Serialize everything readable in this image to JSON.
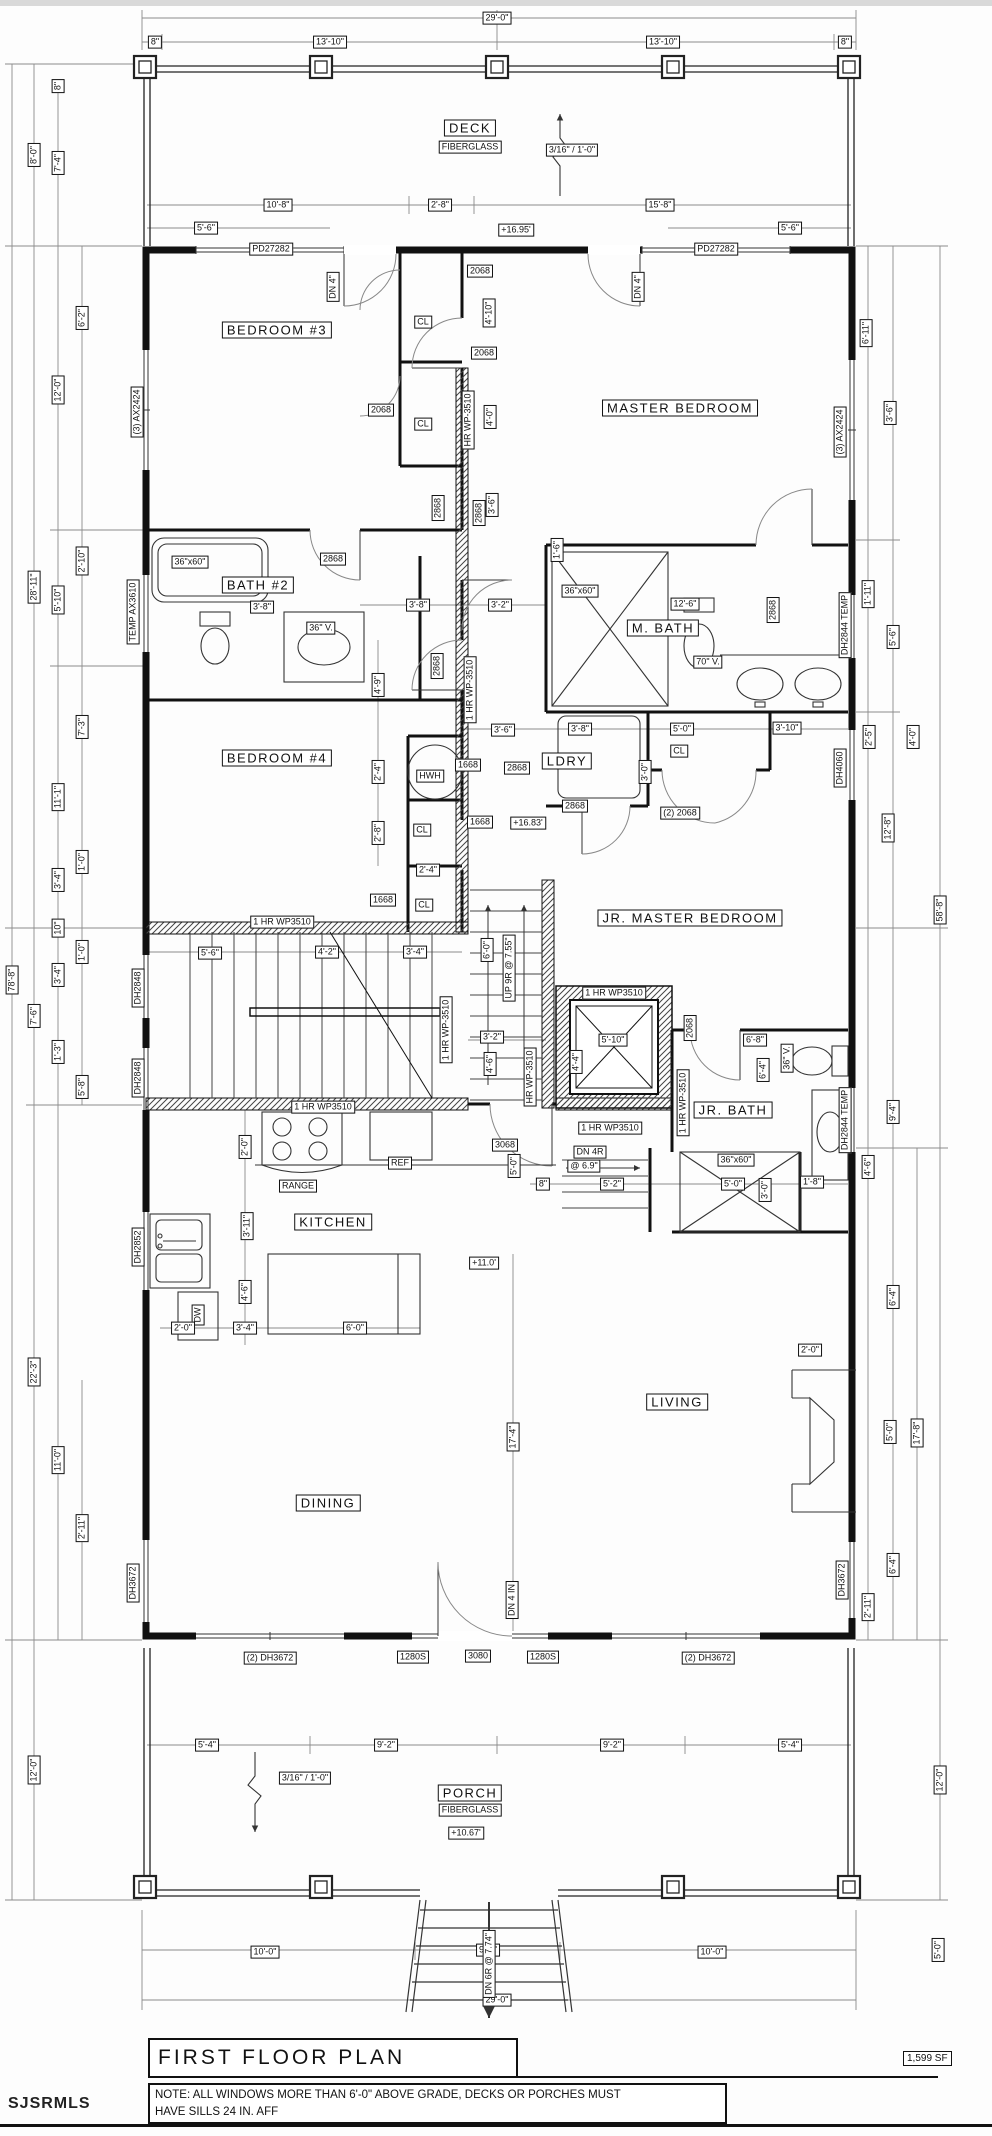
{
  "sheet": {
    "title": "FIRST FLOOR PLAN",
    "area": "1,599 SF",
    "watermark": "SJSRMLS",
    "note": [
      "NOTE:  ALL WINDOWS MORE THAN 6'-0\" ABOVE GRADE, DECKS OR PORCHES MUST",
      "HAVE SILLS 24 IN. AFF"
    ]
  },
  "plan": {
    "rooms": [
      {
        "name": "DECK",
        "x": 470,
        "y": 128
      },
      {
        "name": "BEDROOM #3",
        "x": 277,
        "y": 330
      },
      {
        "name": "MASTER BEDROOM",
        "x": 680,
        "y": 408
      },
      {
        "name": "BATH #2",
        "x": 258,
        "y": 585
      },
      {
        "name": "M. BATH",
        "x": 663,
        "y": 628
      },
      {
        "name": "BEDROOM #4",
        "x": 277,
        "y": 758
      },
      {
        "name": "LDRY",
        "x": 567,
        "y": 761
      },
      {
        "name": "JR. MASTER BEDROOM",
        "x": 690,
        "y": 918
      },
      {
        "name": "JR. BATH",
        "x": 733,
        "y": 1110
      },
      {
        "name": "KITCHEN",
        "x": 333,
        "y": 1222
      },
      {
        "name": "LIVING",
        "x": 677,
        "y": 1402
      },
      {
        "name": "DINING",
        "x": 328,
        "y": 1503
      },
      {
        "name": "PORCH",
        "x": 470,
        "y": 1793
      }
    ],
    "labels": [
      {
        "t": "29'-0\"",
        "x": 497,
        "y": 18
      },
      {
        "t": "8\"",
        "x": 155,
        "y": 42
      },
      {
        "t": "13'-10\"",
        "x": 330,
        "y": 42
      },
      {
        "t": "13'-10\"",
        "x": 663,
        "y": 42
      },
      {
        "t": "8\"",
        "x": 845,
        "y": 42
      },
      {
        "t": "3/16\" / 1'-0\"",
        "x": 572,
        "y": 150
      },
      {
        "t": "FIBERGLASS",
        "x": 470,
        "y": 147
      },
      {
        "t": "10'-8\"",
        "x": 278,
        "y": 205
      },
      {
        "t": "2'-8\"",
        "x": 440,
        "y": 205
      },
      {
        "t": "15'-8\"",
        "x": 660,
        "y": 205
      },
      {
        "t": "5'-6\"",
        "x": 206,
        "y": 228
      },
      {
        "t": "+16.95'",
        "x": 516,
        "y": 230
      },
      {
        "t": "5'-6\"",
        "x": 790,
        "y": 228
      },
      {
        "t": "PD27282",
        "x": 271,
        "y": 249
      },
      {
        "t": "PD27282",
        "x": 716,
        "y": 249
      },
      {
        "t": "DN 4\"",
        "x": 333,
        "y": 287,
        "r": 1
      },
      {
        "t": "DN 4\"",
        "x": 638,
        "y": 287,
        "r": 1
      },
      {
        "t": "2068",
        "x": 480,
        "y": 271
      },
      {
        "t": "4'-10\"",
        "x": 489,
        "y": 313,
        "r": 1
      },
      {
        "t": "2068",
        "x": 484,
        "y": 353
      },
      {
        "t": "CL",
        "x": 423,
        "y": 322
      },
      {
        "t": "CL",
        "x": 423,
        "y": 424
      },
      {
        "t": "2068",
        "x": 381,
        "y": 410
      },
      {
        "t": "HR WP-3510",
        "x": 468,
        "y": 420,
        "r": 1
      },
      {
        "t": "4'-0\"",
        "x": 490,
        "y": 417,
        "r": 1
      },
      {
        "t": "(3) AX2424",
        "x": 137,
        "y": 412,
        "r": 1
      },
      {
        "t": "(3) AX2424",
        "x": 840,
        "y": 432,
        "r": 1
      },
      {
        "t": "6'-11\"",
        "x": 866,
        "y": 333,
        "r": 1
      },
      {
        "t": "3'-6\"",
        "x": 890,
        "y": 413,
        "r": 1
      },
      {
        "t": "2868",
        "x": 438,
        "y": 508,
        "r": 1
      },
      {
        "t": "2868",
        "x": 479,
        "y": 513,
        "r": 1
      },
      {
        "t": "3'-6\"",
        "x": 492,
        "y": 505,
        "r": 1
      },
      {
        "t": "1'-6\"",
        "x": 557,
        "y": 550,
        "r": 1
      },
      {
        "t": "36\"x60\"",
        "x": 190,
        "y": 562
      },
      {
        "t": "3'-8\"",
        "x": 262,
        "y": 607
      },
      {
        "t": "2868",
        "x": 333,
        "y": 559
      },
      {
        "t": "36\" V.",
        "x": 321,
        "y": 628
      },
      {
        "t": "TEMP AX3610",
        "x": 133,
        "y": 612,
        "r": 1
      },
      {
        "t": "3'-8\"",
        "x": 418,
        "y": 605
      },
      {
        "t": "3'-2\"",
        "x": 500,
        "y": 605
      },
      {
        "t": "4'-9\"",
        "x": 378,
        "y": 685,
        "r": 1
      },
      {
        "t": "2868",
        "x": 437,
        "y": 666,
        "r": 1
      },
      {
        "t": "1 HR WP-3510",
        "x": 470,
        "y": 690,
        "r": 1
      },
      {
        "t": "36\"x60\"",
        "x": 580,
        "y": 591
      },
      {
        "t": "12'-6\"",
        "x": 685,
        "y": 604
      },
      {
        "t": "2868",
        "x": 773,
        "y": 610,
        "r": 1
      },
      {
        "t": "70\" V.",
        "x": 708,
        "y": 662
      },
      {
        "t": "DH2844 TEMP",
        "x": 845,
        "y": 625,
        "r": 1
      },
      {
        "t": "1'-11\"",
        "x": 868,
        "y": 594,
        "r": 1
      },
      {
        "t": "5'-6\"",
        "x": 893,
        "y": 637,
        "r": 1
      },
      {
        "t": "2'-4\"",
        "x": 378,
        "y": 772,
        "r": 1
      },
      {
        "t": "HWH",
        "x": 430,
        "y": 776
      },
      {
        "t": "1668",
        "x": 468,
        "y": 765
      },
      {
        "t": "3'-6\"",
        "x": 503,
        "y": 730
      },
      {
        "t": "2868",
        "x": 517,
        "y": 768
      },
      {
        "t": "3'-8\"",
        "x": 580,
        "y": 729
      },
      {
        "t": "5'-0\"",
        "x": 682,
        "y": 729
      },
      {
        "t": "CL",
        "x": 679,
        "y": 751
      },
      {
        "t": "3'-0\"",
        "x": 645,
        "y": 772,
        "r": 1
      },
      {
        "t": "2868",
        "x": 575,
        "y": 806
      },
      {
        "t": "(2) 2068",
        "x": 680,
        "y": 813
      },
      {
        "t": "2'-8\"",
        "x": 378,
        "y": 833,
        "r": 1
      },
      {
        "t": "CL",
        "x": 422,
        "y": 830
      },
      {
        "t": "1668",
        "x": 480,
        "y": 822
      },
      {
        "t": "+16.83'",
        "x": 528,
        "y": 823
      },
      {
        "t": "3'-10\"",
        "x": 787,
        "y": 728
      },
      {
        "t": "DH4060",
        "x": 840,
        "y": 768,
        "r": 1
      },
      {
        "t": "2'-5\"",
        "x": 869,
        "y": 737,
        "r": 1
      },
      {
        "t": "4'-0\"",
        "x": 913,
        "y": 737,
        "r": 1
      },
      {
        "t": "2'-4\"",
        "x": 428,
        "y": 870
      },
      {
        "t": "1668",
        "x": 383,
        "y": 900
      },
      {
        "t": "CL",
        "x": 424,
        "y": 905
      },
      {
        "t": "12'-8\"",
        "x": 888,
        "y": 828,
        "r": 1
      },
      {
        "t": "58'-8\"",
        "x": 940,
        "y": 910,
        "r": 1
      },
      {
        "t": "1 HR WP3510",
        "x": 282,
        "y": 922
      },
      {
        "t": "5'-6\"",
        "x": 210,
        "y": 953
      },
      {
        "t": "4'-2\"",
        "x": 327,
        "y": 952
      },
      {
        "t": "3'-4\"",
        "x": 415,
        "y": 952
      },
      {
        "t": "6'-0\"",
        "x": 487,
        "y": 950,
        "r": 1
      },
      {
        "t": "UP 9R @ 7.55\"",
        "x": 509,
        "y": 968,
        "r": 1
      },
      {
        "t": "DH2848",
        "x": 138,
        "y": 988,
        "r": 1
      },
      {
        "t": "DH2848",
        "x": 138,
        "y": 1078,
        "r": 1
      },
      {
        "t": "1 HR WP-3510",
        "x": 446,
        "y": 1030,
        "r": 1
      },
      {
        "t": "1 HR WP3510",
        "x": 614,
        "y": 993
      },
      {
        "t": "5'-10\"",
        "x": 613,
        "y": 1040
      },
      {
        "t": "4'-4\"",
        "x": 576,
        "y": 1062,
        "r": 1
      },
      {
        "t": "3'-2\"",
        "x": 492,
        "y": 1037
      },
      {
        "t": "4'-6\"",
        "x": 490,
        "y": 1064,
        "r": 1
      },
      {
        "t": "HR WP-3510",
        "x": 530,
        "y": 1077,
        "r": 1
      },
      {
        "t": "2068",
        "x": 690,
        "y": 1028,
        "r": 1
      },
      {
        "t": "1 HR WP-3510",
        "x": 683,
        "y": 1103,
        "r": 1
      },
      {
        "t": "6'-8\"",
        "x": 755,
        "y": 1040
      },
      {
        "t": "6'-4\"",
        "x": 763,
        "y": 1070,
        "r": 1
      },
      {
        "t": "36\" V.",
        "x": 787,
        "y": 1058,
        "r": 1
      },
      {
        "t": "DH2844 TEMP",
        "x": 845,
        "y": 1120,
        "r": 1
      },
      {
        "t": "9'-4\"",
        "x": 893,
        "y": 1112,
        "r": 1
      },
      {
        "t": "4'-6\"",
        "x": 868,
        "y": 1167,
        "r": 1
      },
      {
        "t": "1 HR WP3510",
        "x": 610,
        "y": 1128
      },
      {
        "t": "1 HR WP3510",
        "x": 323,
        "y": 1107
      },
      {
        "t": "DN 4R",
        "x": 590,
        "y": 1152
      },
      {
        "t": "@ 6.9\"",
        "x": 584,
        "y": 1166
      },
      {
        "t": "3068",
        "x": 505,
        "y": 1145
      },
      {
        "t": "5'-0\"",
        "x": 514,
        "y": 1166,
        "r": 1
      },
      {
        "t": "8\"",
        "x": 543,
        "y": 1184
      },
      {
        "t": "5'-2\"",
        "x": 612,
        "y": 1184
      },
      {
        "t": "36\"x60\"",
        "x": 736,
        "y": 1160
      },
      {
        "t": "5'-0\"",
        "x": 733,
        "y": 1184
      },
      {
        "t": "3'-0\"",
        "x": 765,
        "y": 1190,
        "r": 1
      },
      {
        "t": "1'-8\"",
        "x": 812,
        "y": 1182
      },
      {
        "t": "6'-4\"",
        "x": 893,
        "y": 1297,
        "r": 1
      },
      {
        "t": "2'-0\"",
        "x": 245,
        "y": 1147,
        "r": 1
      },
      {
        "t": "RANGE",
        "x": 298,
        "y": 1186
      },
      {
        "t": "REF",
        "x": 400,
        "y": 1163
      },
      {
        "t": "3'-11\"",
        "x": 247,
        "y": 1226,
        "r": 1
      },
      {
        "t": "DH2852",
        "x": 138,
        "y": 1247,
        "r": 1
      },
      {
        "t": "DW",
        "x": 198,
        "y": 1315,
        "r": 1
      },
      {
        "t": "+11.0'",
        "x": 484,
        "y": 1263
      },
      {
        "t": "4'-6\"",
        "x": 245,
        "y": 1292,
        "r": 1
      },
      {
        "t": "2'-0\"",
        "x": 183,
        "y": 1328
      },
      {
        "t": "3'-4\"",
        "x": 245,
        "y": 1328
      },
      {
        "t": "6'-0\"",
        "x": 355,
        "y": 1328
      },
      {
        "t": "17'-4\"",
        "x": 513,
        "y": 1437,
        "r": 1
      },
      {
        "t": "2'-0\"",
        "x": 810,
        "y": 1350
      },
      {
        "t": "5'-0\"",
        "x": 890,
        "y": 1432,
        "r": 1
      },
      {
        "t": "17'-8\"",
        "x": 917,
        "y": 1433,
        "r": 1
      },
      {
        "t": "6'-4\"",
        "x": 893,
        "y": 1565,
        "r": 1
      },
      {
        "t": "2'-11\"",
        "x": 868,
        "y": 1607,
        "r": 1
      },
      {
        "t": "DH3672",
        "x": 842,
        "y": 1580,
        "r": 1
      },
      {
        "t": "DH3672",
        "x": 133,
        "y": 1583,
        "r": 1
      },
      {
        "t": "DN 4 IN",
        "x": 512,
        "y": 1600,
        "r": 1
      },
      {
        "t": "(2) DH3672",
        "x": 270,
        "y": 1658
      },
      {
        "t": "1280S",
        "x": 413,
        "y": 1657
      },
      {
        "t": "3080",
        "x": 478,
        "y": 1656
      },
      {
        "t": "1280S",
        "x": 543,
        "y": 1657
      },
      {
        "t": "(2) DH3672",
        "x": 708,
        "y": 1658
      },
      {
        "t": "5'-4\"",
        "x": 207,
        "y": 1745
      },
      {
        "t": "9'-2\"",
        "x": 386,
        "y": 1745
      },
      {
        "t": "9'-2\"",
        "x": 612,
        "y": 1745
      },
      {
        "t": "5'-4\"",
        "x": 790,
        "y": 1745
      },
      {
        "t": "3/16\" / 1'-0\"",
        "x": 305,
        "y": 1778
      },
      {
        "t": "FIBERGLASS",
        "x": 470,
        "y": 1810
      },
      {
        "t": "+10.67'",
        "x": 466,
        "y": 1833
      },
      {
        "t": "12'-0\"",
        "x": 940,
        "y": 1780,
        "r": 1
      },
      {
        "t": "10'-0\"",
        "x": 265,
        "y": 1952
      },
      {
        "t": "9'-0\"",
        "x": 488,
        "y": 1950
      },
      {
        "t": "10'-0\"",
        "x": 712,
        "y": 1952
      },
      {
        "t": "29'-0\"",
        "x": 497,
        "y": 2000
      },
      {
        "t": "DN 6R @ 7.74\"",
        "x": 489,
        "y": 1964,
        "r": 1
      },
      {
        "t": "5'-0\"",
        "x": 938,
        "y": 1950,
        "r": 1
      },
      {
        "t": "8\"",
        "x": 58,
        "y": 86,
        "r": 1
      },
      {
        "t": "8'-0\"",
        "x": 34,
        "y": 155,
        "r": 1
      },
      {
        "t": "7'-4\"",
        "x": 58,
        "y": 163,
        "r": 1
      },
      {
        "t": "6'-2\"",
        "x": 82,
        "y": 318,
        "r": 1
      },
      {
        "t": "12'-0\"",
        "x": 58,
        "y": 390,
        "r": 1
      },
      {
        "t": "28'-11\"",
        "x": 34,
        "y": 587,
        "r": 1
      },
      {
        "t": "2'-10\"",
        "x": 82,
        "y": 561,
        "r": 1
      },
      {
        "t": "5'-10\"",
        "x": 58,
        "y": 600,
        "r": 1
      },
      {
        "t": "7'-3\"",
        "x": 82,
        "y": 727,
        "r": 1
      },
      {
        "t": "11'-1\"",
        "x": 58,
        "y": 797,
        "r": 1
      },
      {
        "t": "1'-0\"",
        "x": 82,
        "y": 862,
        "r": 1
      },
      {
        "t": "3'-4\"",
        "x": 58,
        "y": 880,
        "r": 1
      },
      {
        "t": "10\"",
        "x": 58,
        "y": 928,
        "r": 1
      },
      {
        "t": "1'-0\"",
        "x": 82,
        "y": 952,
        "r": 1
      },
      {
        "t": "3'-4\"",
        "x": 58,
        "y": 975,
        "r": 1
      },
      {
        "t": "1'-3\"",
        "x": 58,
        "y": 1052,
        "r": 1
      },
      {
        "t": "5'-8\"",
        "x": 82,
        "y": 1087,
        "r": 1
      },
      {
        "t": "7'-6\"",
        "x": 34,
        "y": 1016,
        "r": 1
      },
      {
        "t": "22'-3\"",
        "x": 34,
        "y": 1372,
        "r": 1
      },
      {
        "t": "11'-0\"",
        "x": 58,
        "y": 1460,
        "r": 1
      },
      {
        "t": "2'-11\"",
        "x": 82,
        "y": 1528,
        "r": 1
      },
      {
        "t": "12'-0\"",
        "x": 34,
        "y": 1770,
        "r": 1
      },
      {
        "t": "78'-8\"",
        "x": 12,
        "y": 980,
        "r": 1
      }
    ]
  }
}
